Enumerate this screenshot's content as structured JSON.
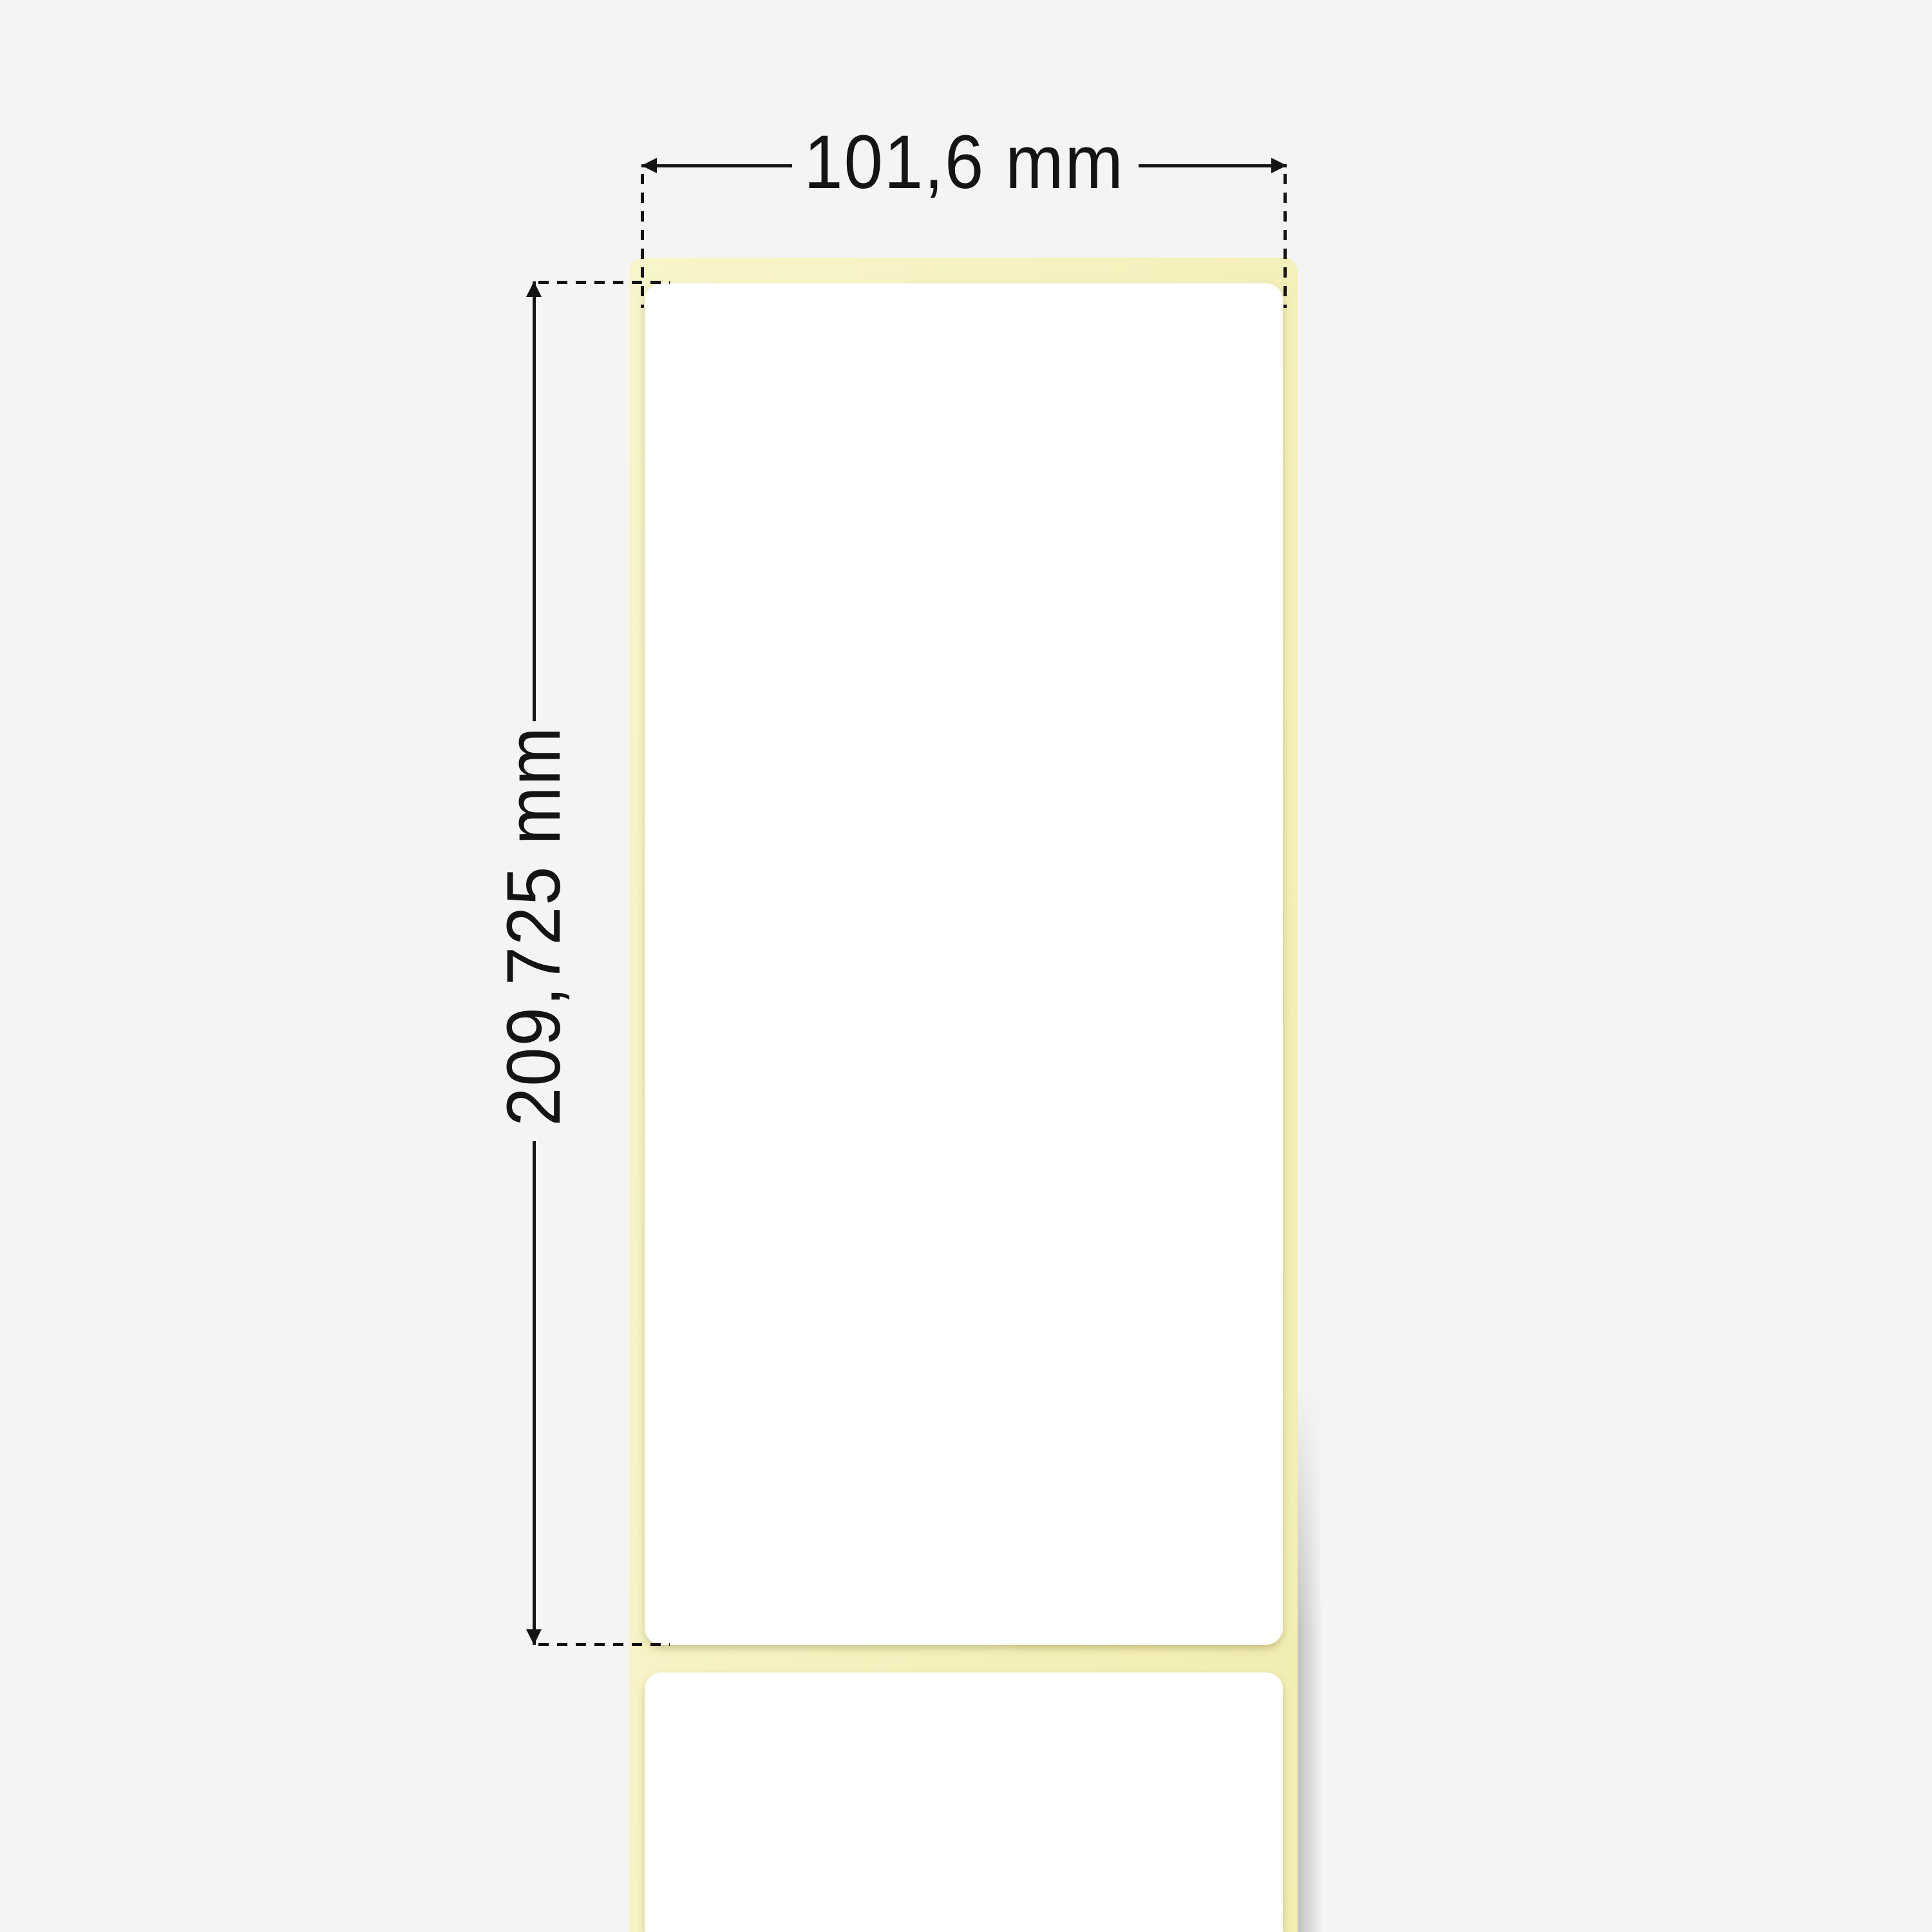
{
  "scene": {
    "background_color": "#f5f4f5",
    "liner_color": "#f6f2c0",
    "label_color": "#ffffff",
    "annotation_color": "#141414"
  },
  "dimensions": {
    "width": {
      "value": "101,6 mm"
    },
    "height": {
      "value": "209,725 mm"
    }
  }
}
